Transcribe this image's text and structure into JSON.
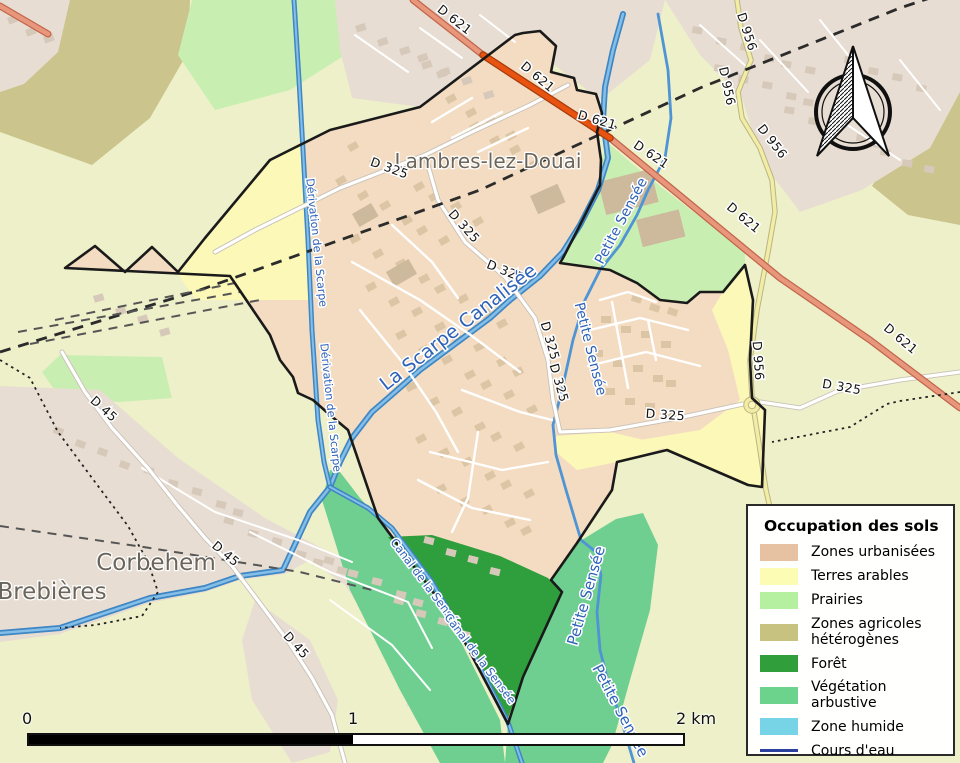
{
  "map": {
    "place_labels": [
      {
        "text": "Lambres-lez-Douai"
      },
      {
        "text": "Corbehem"
      },
      {
        "text": "Brebières"
      }
    ],
    "road_labels": [
      {
        "text": "D 621"
      },
      {
        "text": "D 621"
      },
      {
        "text": "D 621"
      },
      {
        "text": "D 621"
      },
      {
        "text": "D 621"
      },
      {
        "text": "D 621"
      },
      {
        "text": "D 956"
      },
      {
        "text": "D 956"
      },
      {
        "text": "D 956"
      },
      {
        "text": "D 956"
      },
      {
        "text": "D 325"
      },
      {
        "text": "D 325"
      },
      {
        "text": "D 325"
      },
      {
        "text": "D 325"
      },
      {
        "text": "D 325"
      },
      {
        "text": "D 325"
      },
      {
        "text": "D 325"
      },
      {
        "text": "D 45"
      },
      {
        "text": "D 45"
      },
      {
        "text": "D 45"
      }
    ],
    "water_labels": [
      {
        "text": "La Scarpe Canalisée"
      },
      {
        "text": "Dérivation de la Scarpe"
      },
      {
        "text": "Dérivation de la Scarpe"
      },
      {
        "text": "Petite Sensée"
      },
      {
        "text": "Petite Sensée"
      },
      {
        "text": "Petite Sensée"
      },
      {
        "text": "Petite Sensée"
      },
      {
        "text": "Canal de la Sensée"
      },
      {
        "text": "Canal de la Sensée"
      }
    ]
  },
  "legend": {
    "title": "Occupation des sols",
    "items": [
      {
        "label": "Zones urbanisées",
        "color": "#e6c2a3",
        "type": "fill"
      },
      {
        "label": "Terres arables",
        "color": "#fdfcb4",
        "type": "fill"
      },
      {
        "label": "Prairies",
        "color": "#b5f0a0",
        "type": "fill"
      },
      {
        "label": "Zones agricoles hétérogènes",
        "color": "#c8c280",
        "type": "fill"
      },
      {
        "label": "Forêt",
        "color": "#2f9e3b",
        "type": "fill"
      },
      {
        "label": "Végétation arbustive",
        "color": "#6bd38b",
        "type": "fill"
      },
      {
        "label": "Zone humide",
        "color": "#77d4e6",
        "type": "fill"
      },
      {
        "label": "Cours d'eau",
        "color": "#2b3f9e",
        "type": "line"
      }
    ]
  },
  "scalebar": {
    "start": "0",
    "middle": "1",
    "end": "2 km"
  },
  "colors": {
    "water": "#4f94d4",
    "road_primary": "#e8967c",
    "road_primary_bright": "#e85311",
    "road_secondary": "#f2eda2",
    "commune_boundary": "#1a1a1a"
  }
}
